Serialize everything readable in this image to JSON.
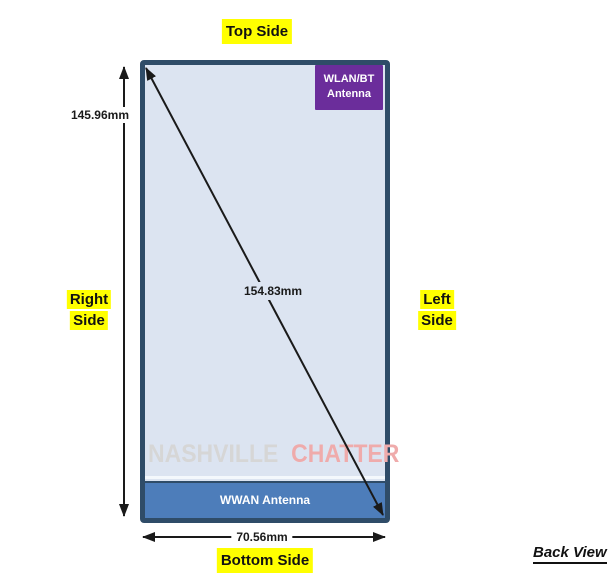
{
  "diagram": {
    "view_label": "Back View",
    "type": "device-antenna-placement"
  },
  "labels": {
    "top_side": "Top Side",
    "bottom_side": "Bottom Side",
    "right_side": [
      "Right",
      "Side"
    ],
    "left_side": [
      "Left",
      "Side"
    ]
  },
  "dimensions": {
    "height": "145.96mm",
    "diagonal": "154.83mm",
    "width": "70.56mm"
  },
  "antennas": {
    "wlan_bt_line1": "WLAN/BT",
    "wlan_bt_line2": "Antenna",
    "wwan": "WWAN Antenna"
  },
  "watermark": {
    "part1": "NASHVILLE",
    "part2": "CHATTER"
  },
  "colors": {
    "highlight_yellow": "#ffff00",
    "device_border": "#2f4c68",
    "device_fill": "#dce4f1",
    "wlan_purple": "#6b2d9b",
    "wwan_blue": "#4d7dba",
    "watermark_gray": "#d6d6d6",
    "watermark_red": "#efabab",
    "arrow_black": "#1a1a1a"
  }
}
